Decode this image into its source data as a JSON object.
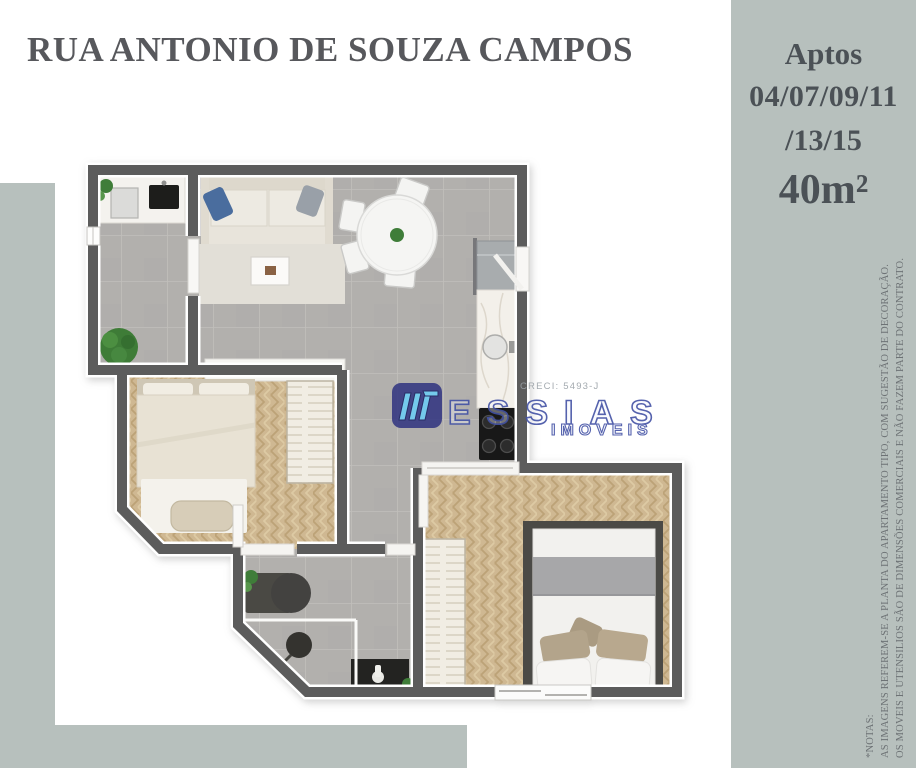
{
  "title": {
    "text": "RUA ANTONIO DE SOUZA CAMPOS"
  },
  "info_panel": {
    "line1": "Aptos",
    "line2": "04/07/09/11",
    "line3": "/13/15",
    "area": "40m²"
  },
  "watermark": {
    "creci": "CRECI: 5493-J",
    "brand": "ESSIAS",
    "brand_sub": "IMOVEIS"
  },
  "notes": {
    "heading": "*NOTAS:",
    "note1": "AS IMAGENS REFEREM-SE A PLANTA DO APARTAMENTO TIPO, COM SUGESTÃO DE DECORAÇÃO.",
    "note2": "OS MOVEIS E UTENSILIOS SÃO DE DIMENSÕES COMERCIAIS E NÃO FAZEM PARTE DO CONTRATO."
  },
  "colors": {
    "panel_bg": "#b7c0bd",
    "title_text": "#57585c",
    "panel_text": "#4b5156",
    "notes_text": "#6d7275",
    "wall": "#5c5c5c",
    "tile_floor": "#b2b0ad",
    "wood_floor": "#cfb892",
    "logo_navy": "#2b2f7e",
    "logo_light_blue": "#6ecdf2",
    "logo_outline": "#4352a5",
    "creci_text": "#9aa1a7",
    "pillow_blue": "#4a6d9e",
    "plant_green": "#3f7d39"
  }
}
